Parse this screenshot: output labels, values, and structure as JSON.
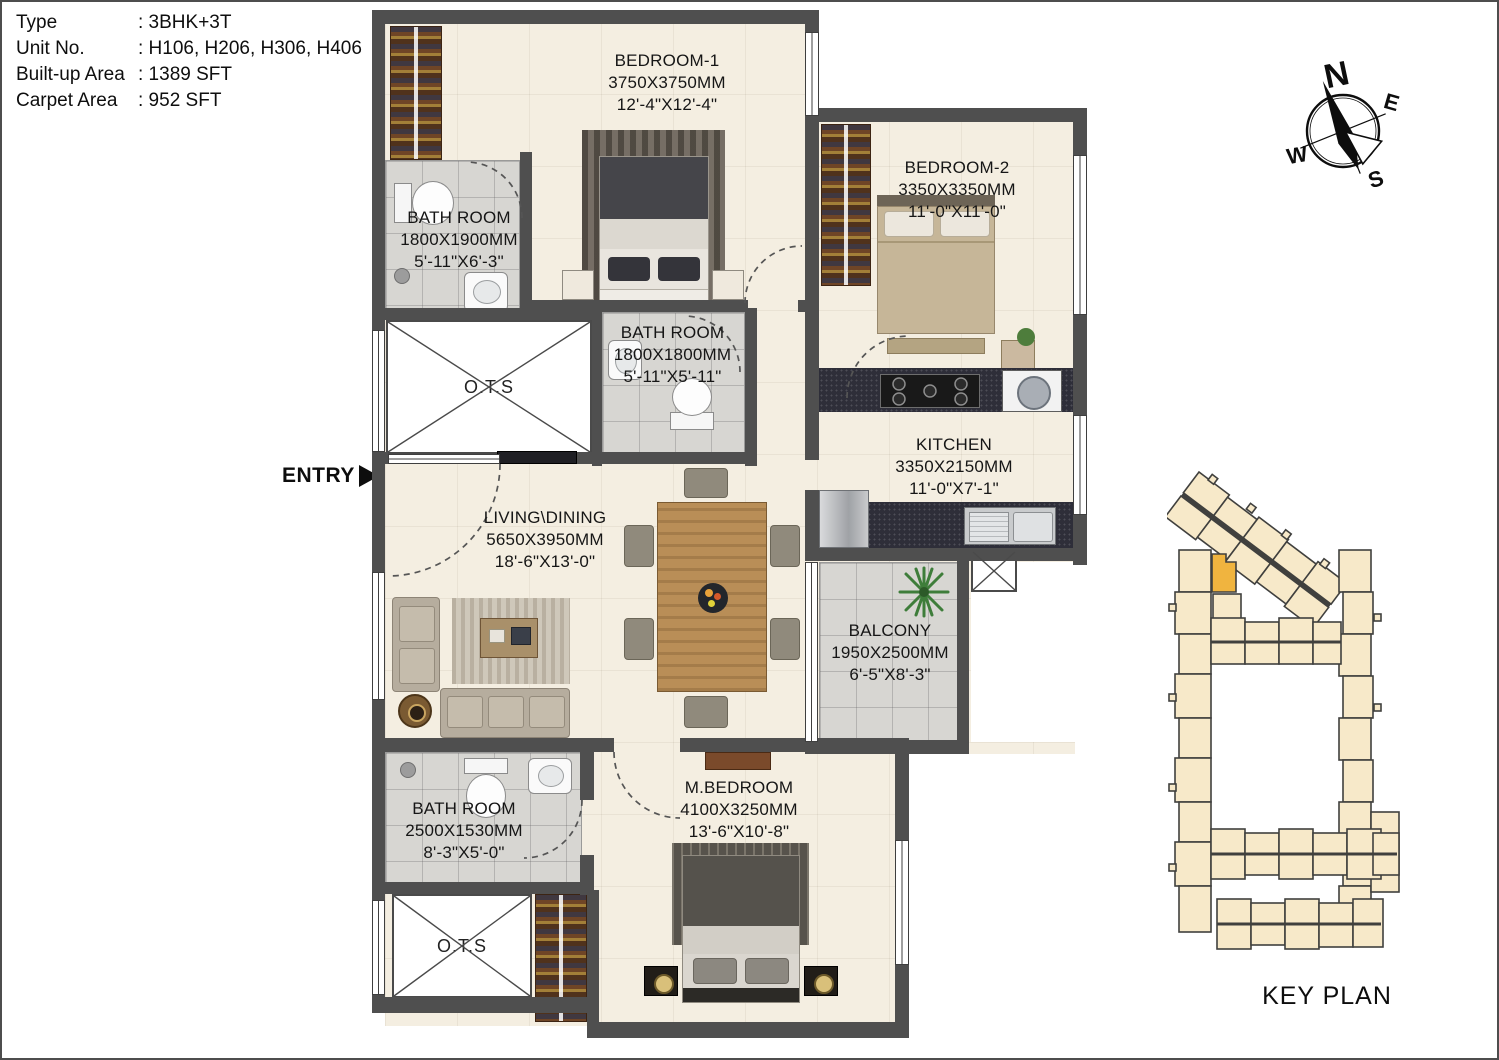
{
  "info": {
    "rows": [
      {
        "label": "Type",
        "value": ": 3BHK+3T"
      },
      {
        "label": "Unit No.",
        "value": ": H106, H206, H306, H406"
      },
      {
        "label": "Built-up Area",
        "value": ": 1389 SFT"
      },
      {
        "label": "Carpet Area",
        "value": ":  952 SFT"
      }
    ]
  },
  "entry": {
    "label": "ENTRY"
  },
  "compass": {
    "n": "N",
    "e": "E",
    "s": "S",
    "w": "W"
  },
  "keyplan": {
    "title": "KEY PLAN"
  },
  "rooms": {
    "bedroom1": {
      "name": "BEDROOM-1",
      "mm": "3750X3750MM",
      "ft": "12'-4\"X12'-4\""
    },
    "bedroom2": {
      "name": "BEDROOM-2",
      "mm": "3350X3350MM",
      "ft": "11'-0\"X11'-0\""
    },
    "bath1": {
      "name": "BATH ROOM",
      "mm": "1800X1900MM",
      "ft": "5'-11\"X6'-3\""
    },
    "bath2": {
      "name": "BATH ROOM",
      "mm": "1800X1800MM",
      "ft": "5'-11\"X5'-11\""
    },
    "bath3": {
      "name": "BATH ROOM",
      "mm": "2500X1530MM",
      "ft": "8'-3\"X5'-0\""
    },
    "kitchen": {
      "name": "KITCHEN",
      "mm": "3350X2150MM",
      "ft": "11'-0\"X7'-1\""
    },
    "living": {
      "name": "LIVING\\DINING",
      "mm": "5650X3950MM",
      "ft": "18'-6\"X13'-0\""
    },
    "balcony": {
      "name": "BALCONY",
      "mm": "1950X2500MM",
      "ft": "6'-5\"X8'-3\""
    },
    "mbedroom": {
      "name": "M.BEDROOM",
      "mm": "4100X3250MM",
      "ft": "13'-6\"X10'-8\""
    },
    "ots_top": {
      "name": "O.T.S"
    },
    "ots_bottom": {
      "name": "O.T.S"
    }
  },
  "colors": {
    "wall": "#4f4f4f",
    "floor": "#f4eee1",
    "tile": "#d7d6d2",
    "keyplan_block": "#f7e9c9",
    "keyplan_highlight": "#f0b43f"
  }
}
